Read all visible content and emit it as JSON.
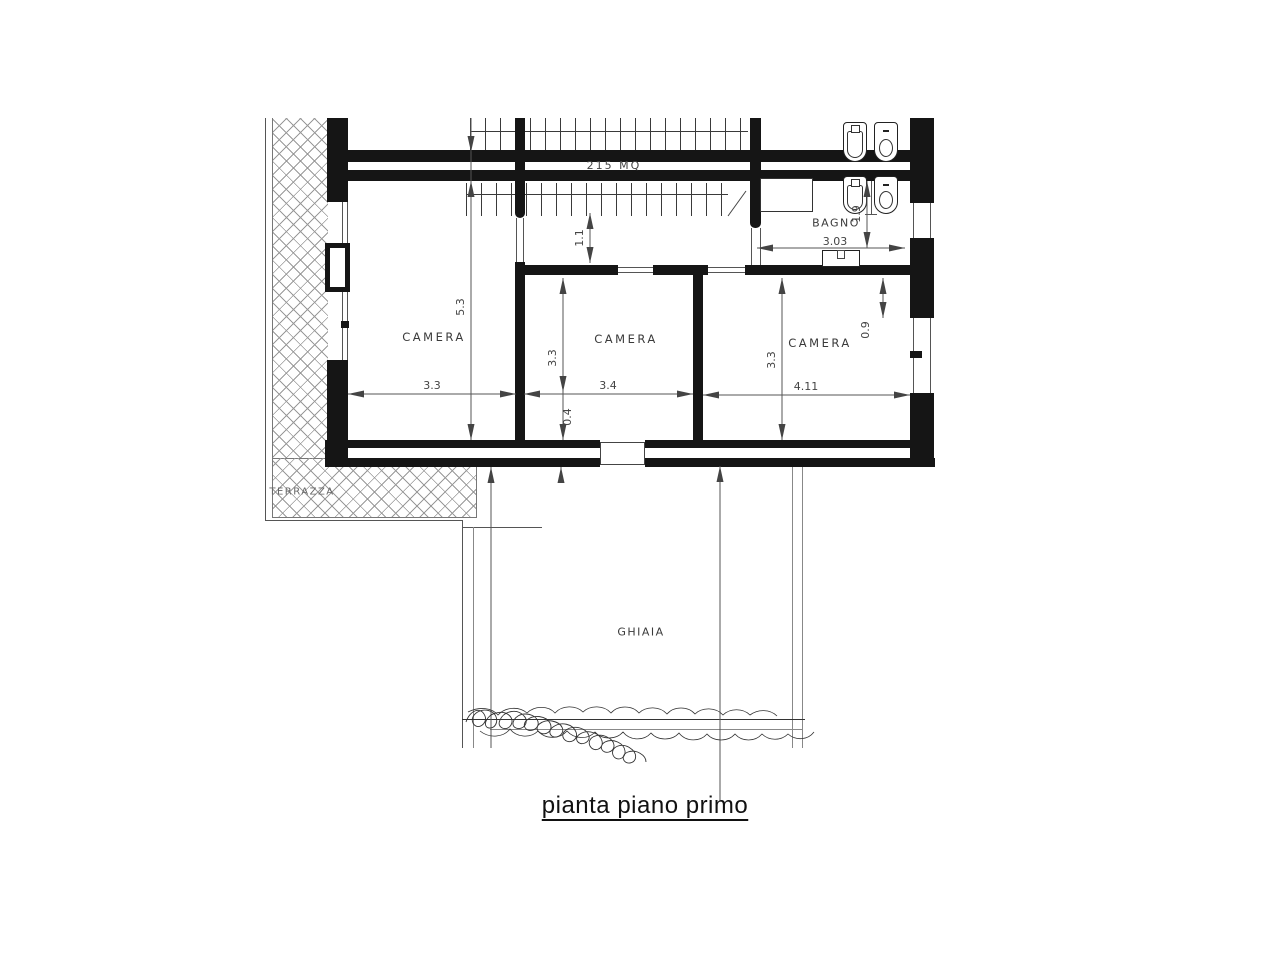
{
  "title": {
    "text": "pianta piano primo"
  },
  "plan": {
    "area_label": "215 MQ",
    "rooms": [
      {
        "id": "camera-left",
        "label": "CAMERA"
      },
      {
        "id": "camera-middle",
        "label": "CAMERA"
      },
      {
        "id": "camera-right",
        "label": "CAMERA"
      },
      {
        "id": "bagno",
        "label": "BAGNO"
      },
      {
        "id": "terrazza",
        "label": "TERRAZZA"
      },
      {
        "id": "ghiaia",
        "label": "GHIAIA"
      }
    ],
    "dimensions": {
      "camera_left_width": "3.3",
      "camera_left_height": "5.3",
      "corridor_depth": "1.1",
      "camera_middle_width": "3.4",
      "camera_middle_height": "3.3",
      "camera_middle_lower": "0.4",
      "camera_right_width": "4.11",
      "camera_right_height": "3.3",
      "camera_right_window": "0.9",
      "bagno_width": "3.03",
      "bagno_depth": "1.9"
    },
    "colors": {
      "wall": "#151515",
      "line": "#555555",
      "hatch": "#999999",
      "text": "#444444",
      "background": "#ffffff"
    }
  }
}
